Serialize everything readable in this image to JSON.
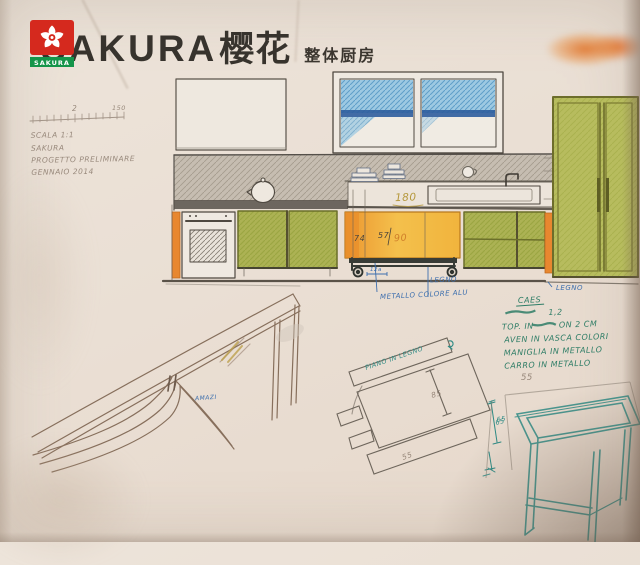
{
  "logo": {
    "brand": "SAKURA",
    "brand_cn": "樱花",
    "tagline": "整体厨房",
    "badge_label": "SAKURA"
  },
  "colors": {
    "brand_red": "#d5291e",
    "brand_green": "#15954a",
    "ink_blue": "#3d6fae",
    "ink_teal": "#2f8b85",
    "note_green": "#2e7d66",
    "cabinet_green": "#aeb455",
    "accent_orange": "#e8872f",
    "cart_yellow": "#f2bb45",
    "window_blue": "#8fc3e0"
  },
  "ruler": {
    "mid_label": "2",
    "end_label": "150"
  },
  "pencil_notes": {
    "l1": "SCALA 1:1",
    "l2": "SAKURA",
    "l3": "PROGETTO PRELIMINARE",
    "l4": "GENNAIO 2014"
  },
  "dims": {
    "counter": "180",
    "cart_h": "74",
    "cart_d": "57",
    "cart_w": "90",
    "wheel": "12a"
  },
  "cart_notes": {
    "legno": "LEGNO",
    "metallo": "METALLO COLORE ALU"
  },
  "tall_cabinet_note": {
    "legno": "LEGNO"
  },
  "side_notes": {
    "caes": "CAES",
    "num": "1,2",
    "top_pre": "TOP. IN",
    "top_post": "ON 2 CM",
    "vasca": "AVEN IN VASCA COLORI",
    "maniglia": "MANIGLIA IN METALLO",
    "carro": "CARRO IN METALLO",
    "dim": "55"
  },
  "detail_sketch": {
    "label": "PIANO IN LEGNO",
    "dim_len": "85",
    "dim_dep": "55",
    "dim_h": "65"
  },
  "frame_sketch": {
    "dim_h": "65"
  },
  "bench_sketch": {
    "note": "AMAZI"
  }
}
